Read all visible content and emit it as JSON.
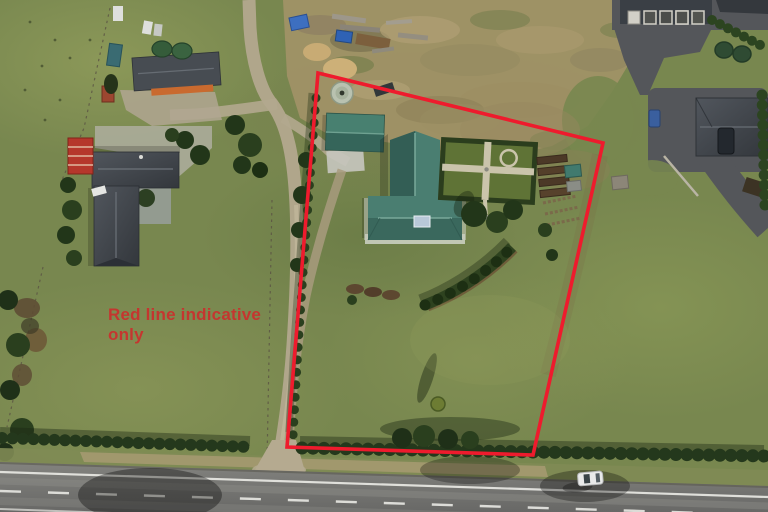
{
  "annotation": {
    "text": "Red line indicative only",
    "color": "#cf2b2b"
  },
  "boundary": {
    "points": "318,73 603,143 533,455 287,447",
    "color": "#ee1b2d",
    "stroke_width": 3.6
  },
  "palette": {
    "grass": "#78874f",
    "grass_light": "#93a05e",
    "scrub_tan": "#a29267",
    "road_gray": "#7b7b78",
    "road_line_white": "#e9e9e4",
    "gravel": "#b3a88e",
    "asphalt_dark": "#55575b",
    "main_roof_teal": "#3f7265",
    "neighbor_roof_charcoal": "#43484e",
    "shed_red": "#a84a30",
    "hedge_green": "#24381c",
    "tank_sage": "#b9c2b0",
    "tarp_blue": "#3a6fc4",
    "deck_white": "#ccd0c3"
  }
}
